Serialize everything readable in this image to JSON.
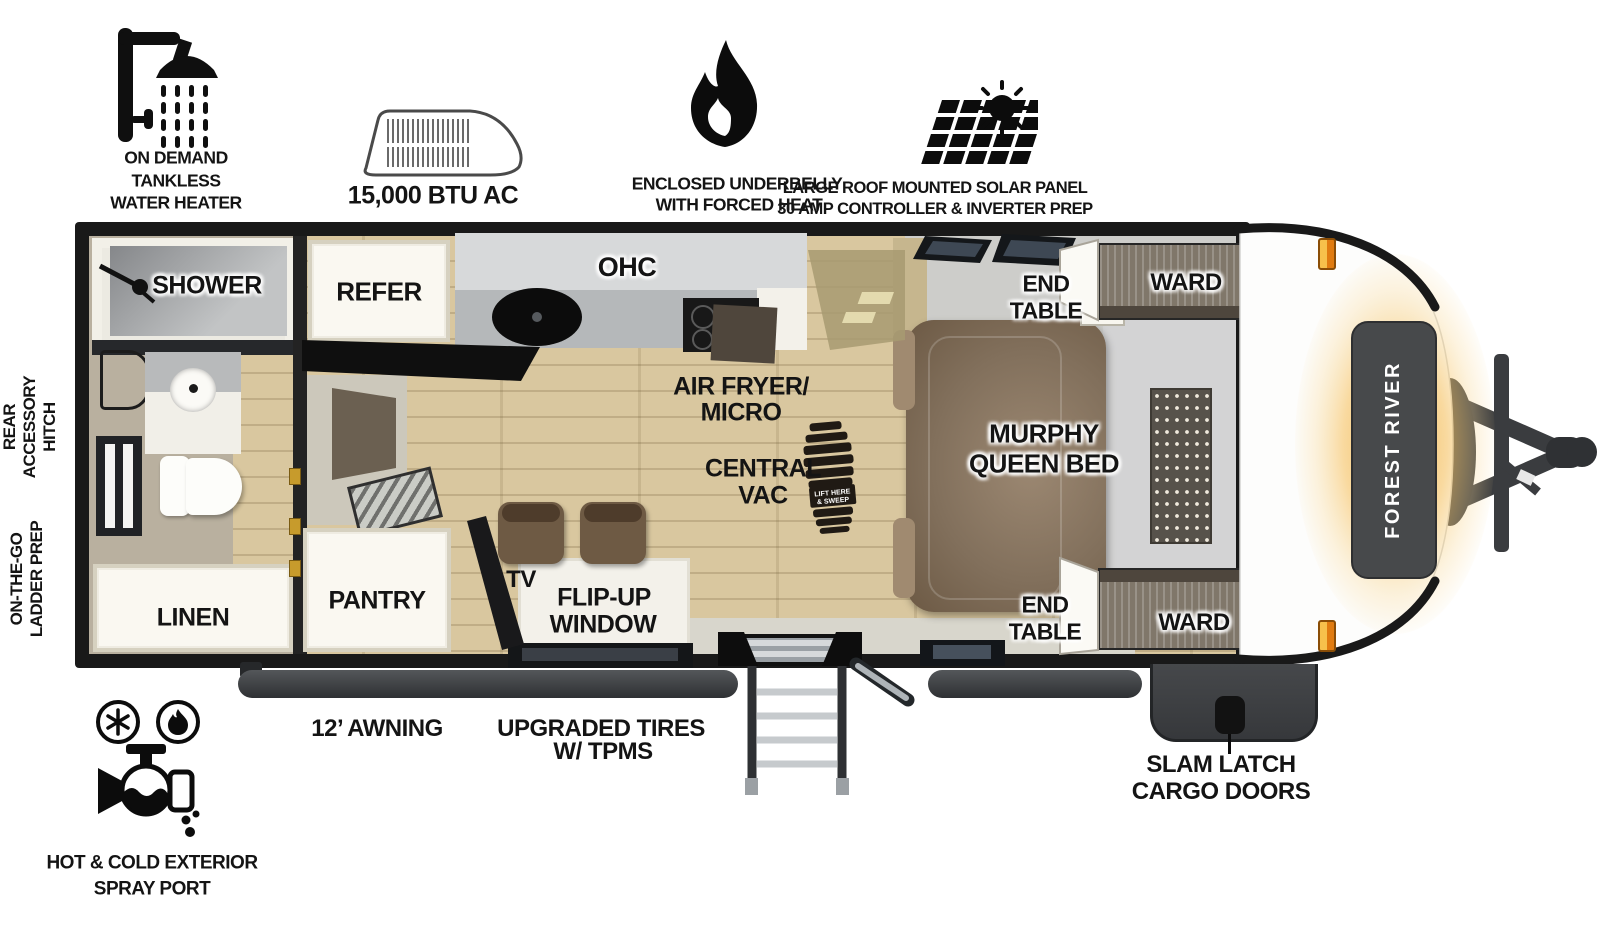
{
  "brand": {
    "label": "FOREST RIVER"
  },
  "exterior_callouts": {
    "water_heater": {
      "icon": "shower-head-icon",
      "lines": [
        "ON DEMAND",
        "TANKLESS",
        "WATER HEATER"
      ]
    },
    "ac": {
      "icon": "ac-unit-icon",
      "label": "15,000 BTU AC"
    },
    "underbelly": {
      "icon": "flame-icon",
      "lines": [
        "ENCLOSED UNDERBELLY",
        "WITH FORCED HEAT"
      ]
    },
    "solar": {
      "icon": "solar-panel-icon",
      "lines": [
        "LARGE ROOF MOUNTED SOLAR PANEL",
        "30 AMP CONTROLLER & INVERTER PREP"
      ]
    },
    "rear_hitch": {
      "lines": [
        "REAR",
        "ACCESSORY",
        "HITCH"
      ]
    },
    "ladder_prep": {
      "lines": [
        "ON-THE-GO",
        "LADDER PREP"
      ]
    },
    "spray_port": {
      "icon": "spray-port-icon",
      "lines": [
        "HOT & COLD EXTERIOR",
        "SPRAY PORT"
      ]
    },
    "awning": {
      "label": "12’ AWNING"
    },
    "tires": {
      "lines": [
        "UPGRADED TIRES",
        "W/ TPMS"
      ]
    },
    "cargo_doors": {
      "lines": [
        "SLAM LATCH",
        "CARGO DOORS"
      ]
    }
  },
  "interior_labels": {
    "shower": "SHOWER",
    "linen": "LINEN",
    "refer": "REFER",
    "ohc": "OHC",
    "air_fryer_micro": {
      "lines": [
        "AIR FRYER/",
        "MICRO"
      ]
    },
    "central_vac": {
      "lines": [
        "CENTRAL",
        "VAC"
      ]
    },
    "pantry": "PANTRY",
    "tv": "TV",
    "flip_up_window": {
      "lines": [
        "FLIP-UP",
        "WINDOW"
      ]
    },
    "end_table_top": {
      "lines": [
        "END",
        "TABLE"
      ]
    },
    "end_table_bottom": {
      "lines": [
        "END",
        "TABLE"
      ]
    },
    "ward_top": "WARD",
    "ward_bottom": "WARD",
    "murphy_bed": {
      "lines": [
        "MURPHY",
        "QUEEN BED"
      ]
    }
  },
  "bootprint_stamp": {
    "lines": [
      "LIFT HERE",
      "& SWEEP"
    ]
  },
  "colors": {
    "wall": "#191919",
    "floor_wood": "#d9c79f",
    "bath_floor": "#b9b09f",
    "accent_orange": "#f2a93b",
    "cap_panel": "#47494b",
    "sofa_brown": "#82705c",
    "awning_tube": "#3b3d40"
  }
}
